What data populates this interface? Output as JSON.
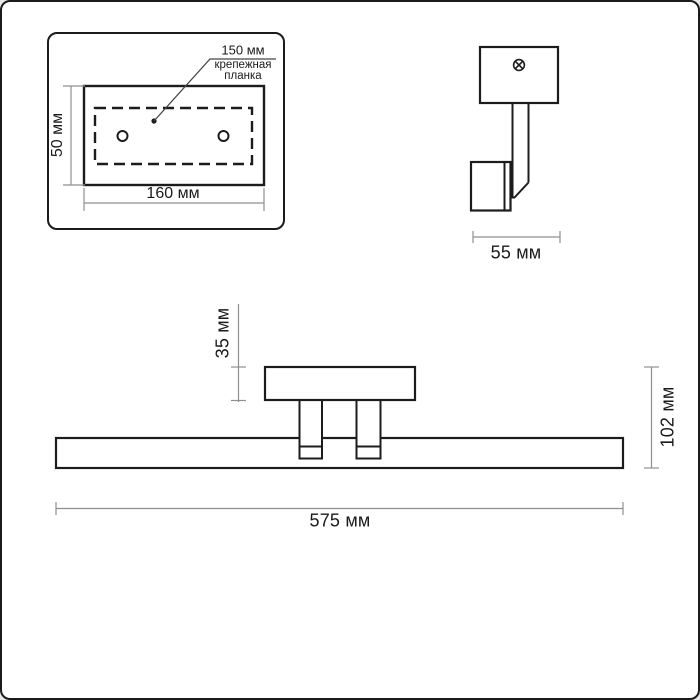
{
  "page": {
    "background": "#ffffff",
    "object_line_color": "#1c1c1c",
    "dimension_line_color": "#8f8f8f"
  },
  "views": {
    "mounting_plate_detail": {
      "hole_spacing_label": "150 мм",
      "callout_line1": "крепежная",
      "callout_line2": "планка",
      "height_label": "50 мм",
      "width_label": "160 мм"
    },
    "side_view": {
      "depth_label": "55 мм"
    },
    "front_view": {
      "bracket_height_label": "35 мм",
      "overall_height_label": "102 мм",
      "length_label": "575 мм"
    }
  },
  "dimensions_mm": {
    "hole_spacing": 150,
    "plate_height": 50,
    "plate_width": 160,
    "depth": 55,
    "bracket_height": 35,
    "overall_height": 102,
    "length": 575
  }
}
